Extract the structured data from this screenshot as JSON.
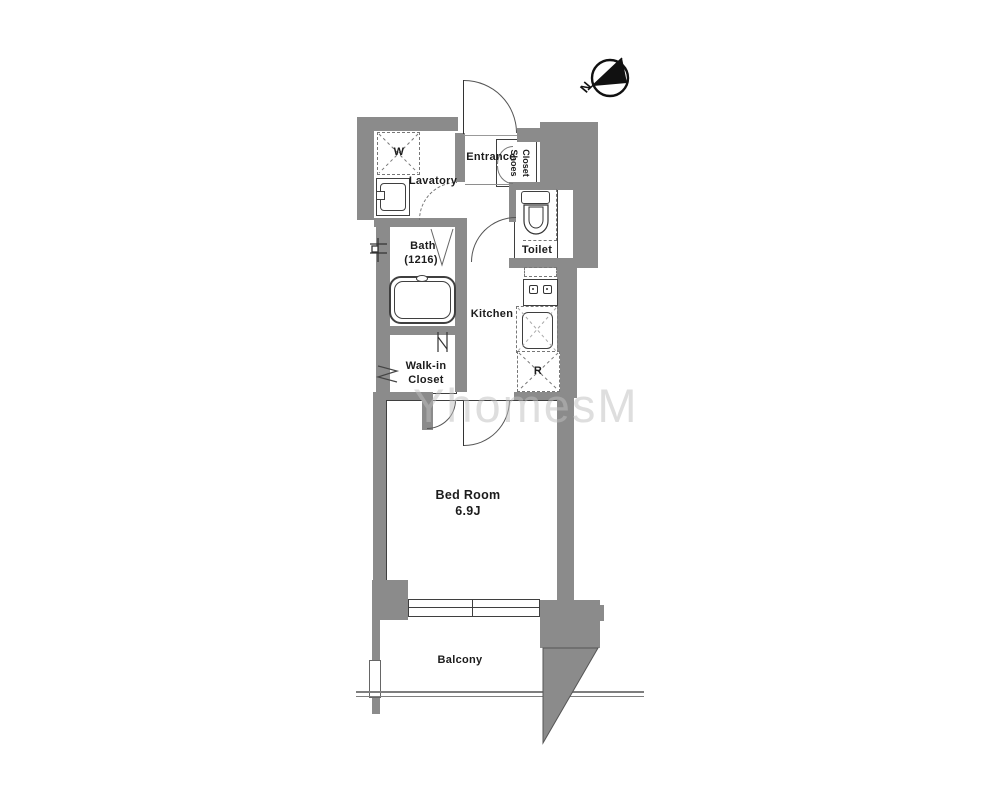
{
  "floor_plan": {
    "title": "studio apartment floor plan",
    "watermark": "YhomesM",
    "compass": {
      "north_label": "N"
    },
    "rooms": {
      "entrance": "Entrance",
      "shoes_closet_line1": "Shoes",
      "shoes_closet_line2": "Closet",
      "lavatory": "Lavatory",
      "bath_line1": "Bath",
      "bath_line2": "(1216)",
      "toilet": "Toilet",
      "kitchen": "Kitchen",
      "walk_in_closet_line1": "Walk-in",
      "walk_in_closet_line2": "Closet",
      "bedroom_line1": "Bed Room",
      "bedroom_size": "6.9J",
      "balcony": "Balcony"
    },
    "fixtures": {
      "washing_machine_symbol": "W",
      "refrigerator_symbol": "R"
    },
    "colors": {
      "wall": "#8b8b8b",
      "outline": "#3f3f3f",
      "background": "#ffffff"
    }
  }
}
